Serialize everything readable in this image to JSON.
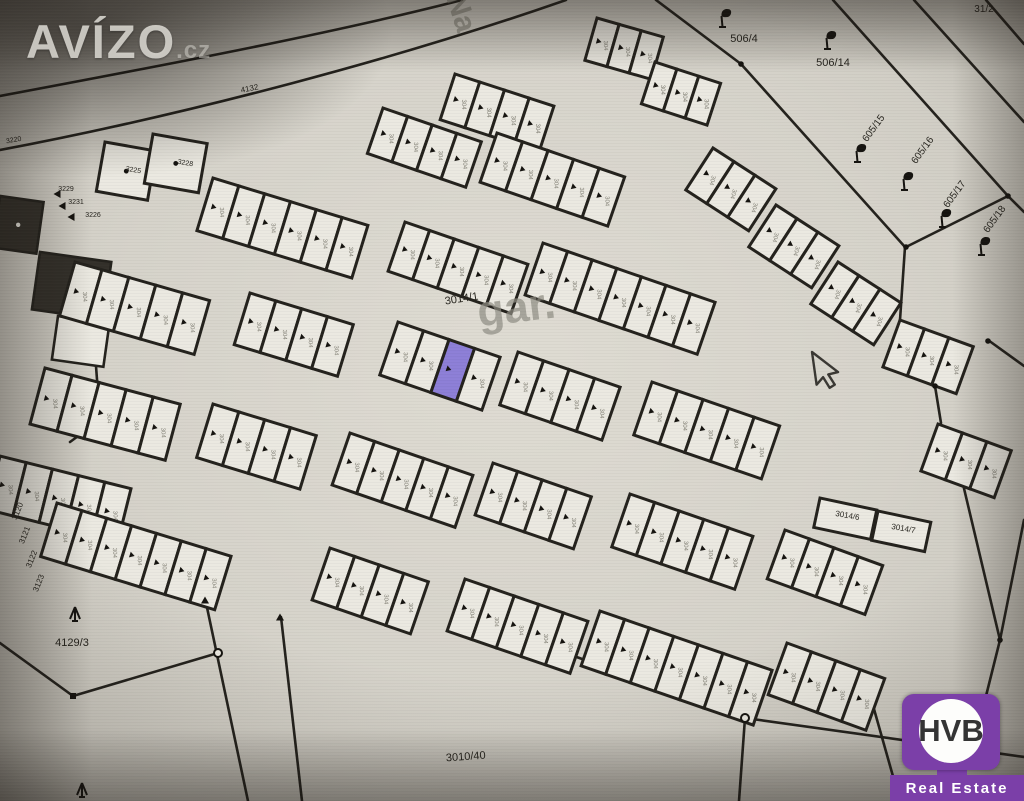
{
  "watermark": {
    "text": "AVÍZO",
    "suffix": ".cz"
  },
  "logo": {
    "text": "HVB",
    "subtext": "Real Estate",
    "purple": "#7b3fa8"
  },
  "map": {
    "colors": {
      "line": "#24221d",
      "cell": "#ebe9e1",
      "highlight": "#8d7fd7",
      "building": "#33302a",
      "text": "#26241e",
      "faint": "#8f8d83"
    },
    "cell_smudge": "304",
    "cursor": {
      "x": 812,
      "y": 352
    },
    "labels": [
      {
        "t": "506/4",
        "x": 744,
        "y": 42,
        "r": 0,
        "s": 11
      },
      {
        "t": "506/14",
        "x": 833,
        "y": 66,
        "r": 0,
        "s": 11
      },
      {
        "t": "31/2",
        "x": 984,
        "y": 12,
        "r": 0,
        "s": 10
      },
      {
        "t": "605/15",
        "x": 876,
        "y": 130,
        "r": -54,
        "s": 10
      },
      {
        "t": "605/16",
        "x": 925,
        "y": 152,
        "r": -54,
        "s": 10
      },
      {
        "t": "605/17",
        "x": 957,
        "y": 196,
        "r": -54,
        "s": 10
      },
      {
        "t": "605/18",
        "x": 997,
        "y": 221,
        "r": -54,
        "s": 10
      },
      {
        "t": "4132",
        "x": 250,
        "y": 91,
        "r": -11,
        "s": 8
      },
      {
        "t": "Na",
        "x": 452,
        "y": 16,
        "r": 72,
        "s": 30,
        "c": "faint"
      },
      {
        "t": "3014/1",
        "x": 462,
        "y": 302,
        "r": -9,
        "s": 11
      },
      {
        "t": "gar.",
        "x": 518,
        "y": 322,
        "r": -7,
        "s": 44,
        "c": "faint"
      },
      {
        "t": "4129/3",
        "x": 72,
        "y": 646,
        "r": 0,
        "s": 11
      },
      {
        "t": "3010/40",
        "x": 466,
        "y": 760,
        "r": -4,
        "s": 11
      },
      {
        "t": "3014/6",
        "x": 847,
        "y": 518,
        "r": 10,
        "s": 8
      },
      {
        "t": "3014/7",
        "x": 903,
        "y": 531,
        "r": 10,
        "s": 8
      },
      {
        "t": "3229",
        "x": 66,
        "y": 191,
        "r": 0,
        "s": 7
      },
      {
        "t": "3231",
        "x": 76,
        "y": 204,
        "r": 0,
        "s": 7
      },
      {
        "t": "3226",
        "x": 93,
        "y": 217,
        "r": 0,
        "s": 7
      },
      {
        "t": "3225",
        "x": 133,
        "y": 172,
        "r": 10,
        "s": 7
      },
      {
        "t": "3228",
        "x": 185,
        "y": 165,
        "r": 10,
        "s": 7
      },
      {
        "t": "3220",
        "x": 14,
        "y": 142,
        "r": -10,
        "s": 7
      },
      {
        "t": "3120",
        "x": 20,
        "y": 512,
        "r": -68,
        "s": 8
      },
      {
        "t": "3121",
        "x": 27,
        "y": 536,
        "r": -68,
        "s": 8
      },
      {
        "t": "3122",
        "x": 34,
        "y": 560,
        "r": -68,
        "s": 8
      },
      {
        "t": "3123",
        "x": 41,
        "y": 584,
        "r": -68,
        "s": 8
      },
      {
        "t": "Ko",
        "x": 942,
        "y": 797,
        "r": -5,
        "s": 24,
        "c": "faint"
      }
    ],
    "rows": [
      [
        597,
        18,
        16,
        3,
        23,
        44
      ],
      [
        655,
        62,
        18,
        3,
        23,
        44
      ],
      [
        455,
        74,
        18,
        4,
        26,
        48
      ],
      [
        383,
        108,
        19,
        4,
        26,
        48
      ],
      [
        497,
        133,
        19,
        5,
        27,
        52
      ],
      [
        213,
        178,
        17,
        6,
        27,
        55
      ],
      [
        405,
        222,
        19,
        5,
        26,
        52
      ],
      [
        543,
        243,
        19,
        7,
        26,
        55
      ],
      [
        75,
        262,
        16,
        5,
        28,
        56
      ],
      [
        250,
        293,
        17,
        4,
        27,
        54
      ],
      [
        398,
        322,
        19,
        4,
        27,
        56,
        2
      ],
      [
        518,
        352,
        19,
        4,
        27,
        56
      ],
      [
        652,
        382,
        19,
        5,
        27,
        56
      ],
      [
        45,
        368,
        15,
        5,
        28,
        58
      ],
      [
        213,
        404,
        17,
        4,
        27,
        56
      ],
      [
        350,
        433,
        19,
        5,
        26,
        55
      ],
      [
        493,
        463,
        19,
        4,
        26,
        55
      ],
      [
        630,
        494,
        19,
        5,
        26,
        56
      ],
      [
        785,
        530,
        20,
        4,
        26,
        52
      ],
      [
        0,
        456,
        14,
        5,
        27,
        55
      ],
      [
        57,
        503,
        17,
        7,
        26,
        56
      ],
      [
        330,
        548,
        19,
        4,
        26,
        55
      ],
      [
        465,
        579,
        19,
        5,
        26,
        55
      ],
      [
        600,
        611,
        19,
        7,
        26,
        58
      ],
      [
        787,
        643,
        20,
        4,
        26,
        55
      ],
      [
        713,
        148,
        33,
        3,
        25,
        50
      ],
      [
        776,
        205,
        33,
        3,
        25,
        50
      ],
      [
        838,
        262,
        33,
        3,
        25,
        50
      ],
      [
        900,
        320,
        20,
        3,
        26,
        50
      ],
      [
        938,
        424,
        20,
        3,
        26,
        50
      ]
    ],
    "parcels": [
      [
        820,
        498,
        58,
        30,
        12,
        0
      ],
      [
        878,
        511,
        54,
        30,
        12,
        0
      ],
      [
        105,
        142,
        52,
        50,
        10,
        1
      ],
      [
        153,
        134,
        55,
        50,
        10,
        1
      ]
    ],
    "buildings": [
      [
        0,
        196,
        44,
        52,
        8,
        1
      ],
      [
        40,
        252,
        72,
        58,
        8,
        1
      ],
      [
        58,
        316,
        52,
        44,
        8,
        0
      ]
    ],
    "lines": [
      "M0,96 C160,66 330,34 462,0",
      "M0,150 C190,114 400,58 566,0",
      "M656,0 L741,64 L905,247",
      "M833,0 L1008,196",
      "M914,0 L1024,122",
      "M986,0 L1024,44",
      "M906,247 L1008,196",
      "M1008,196 L1024,212",
      "M905,247 L900,320",
      "M988,340 L1024,366",
      "M935,386 L941,423",
      "M962,480 L1000,640 L985,700",
      "M1024,520 L1000,640",
      "M985,700 L948,780",
      "M0,643 L73,696 L218,653",
      "M205,598 L248,801",
      "M281,617 L302,801",
      "M480,622 L745,718 L1024,757",
      "M745,718 L739,801",
      "M872,702 L900,801",
      "M92,312 L100,420",
      "M100,420 L70,442"
    ],
    "flags": [
      [
        722,
        24
      ],
      [
        827,
        46
      ],
      [
        857,
        159
      ],
      [
        904,
        187
      ],
      [
        942,
        224
      ],
      [
        981,
        252
      ]
    ],
    "trees": [
      [
        75,
        614
      ],
      [
        82,
        790
      ]
    ],
    "nodes": {
      "dots": [
        [
          741,
          64
        ],
        [
          906,
          247
        ],
        [
          1008,
          196
        ],
        [
          935,
          386
        ],
        [
          988,
          341
        ],
        [
          1000,
          640
        ]
      ],
      "circles": [
        [
          745,
          718
        ],
        [
          218,
          653
        ]
      ],
      "squares": [
        [
          73,
          696
        ]
      ],
      "triangles": [
        [
          205,
          600,
          0
        ],
        [
          280,
          617,
          0
        ],
        [
          57,
          194,
          -90
        ],
        [
          62,
          206,
          -90
        ],
        [
          71,
          217,
          -90
        ]
      ]
    }
  }
}
